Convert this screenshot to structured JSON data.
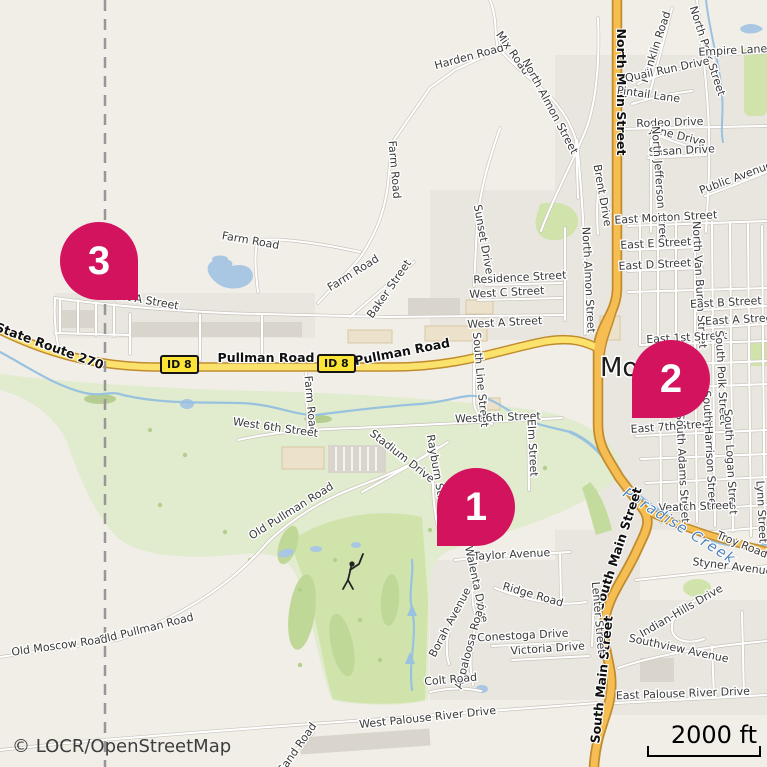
{
  "map": {
    "attribution": "© LOCR/OpenStreetMap",
    "scale_label": "2000 ft",
    "shield_label": "ID 8",
    "city": "Moscow",
    "markers": [
      {
        "number": "1"
      },
      {
        "number": "2"
      },
      {
        "number": "3"
      }
    ],
    "labels": [
      {
        "t": "Harden Road",
        "x": 470,
        "y": 60,
        "r": -15
      },
      {
        "t": "Mix Road",
        "x": 510,
        "y": 55,
        "r": 55
      },
      {
        "t": "North Almon Street",
        "x": 547,
        "y": 108,
        "r": 62
      },
      {
        "t": "Farm Road",
        "x": 391,
        "y": 170,
        "r": 85
      },
      {
        "t": "Farm Road",
        "x": 250,
        "y": 244,
        "r": 10
      },
      {
        "t": "Farm Road",
        "x": 355,
        "y": 276,
        "r": -32
      },
      {
        "t": "Farm Road",
        "x": 307,
        "y": 405,
        "r": 85
      },
      {
        "t": "North Main Street",
        "x": 617,
        "y": 92,
        "r": 90,
        "c": "mainroad"
      },
      {
        "t": "Franklin Road",
        "x": 659,
        "y": 48,
        "r": -72
      },
      {
        "t": "North Polk Street",
        "x": 704,
        "y": 52,
        "r": 72
      },
      {
        "t": "Empire Lane",
        "x": 733,
        "y": 54,
        "r": -3
      },
      {
        "t": "Quail Run Drive",
        "x": 668,
        "y": 73,
        "r": -12
      },
      {
        "t": "Pintail Lane",
        "x": 648,
        "y": 98,
        "r": 8
      },
      {
        "t": "Rodeo Drive",
        "x": 670,
        "y": 126,
        "r": -2
      },
      {
        "t": "June Drive",
        "x": 677,
        "y": 139,
        "r": 14
      },
      {
        "t": "Susan Drive",
        "x": 682,
        "y": 154,
        "r": -3
      },
      {
        "t": "North Jefferson Street",
        "x": 656,
        "y": 186,
        "r": 86
      },
      {
        "t": "Public Avenue",
        "x": 737,
        "y": 181,
        "r": -20
      },
      {
        "t": "Brent Drive",
        "x": 599,
        "y": 196,
        "r": 80
      },
      {
        "t": "East Morton Street",
        "x": 666,
        "y": 221,
        "r": -3
      },
      {
        "t": "East E Street",
        "x": 656,
        "y": 247,
        "r": -3
      },
      {
        "t": "East D Street",
        "x": 655,
        "y": 268,
        "r": -3
      },
      {
        "t": "North Almon Street",
        "x": 585,
        "y": 280,
        "r": 87
      },
      {
        "t": "North Van Buren Street",
        "x": 696,
        "y": 285,
        "r": 87
      },
      {
        "t": "East B Street",
        "x": 726,
        "y": 306,
        "r": -3
      },
      {
        "t": "East A Street",
        "x": 741,
        "y": 323,
        "r": -3
      },
      {
        "t": "East 1st Street",
        "x": 687,
        "y": 341,
        "r": -3
      },
      {
        "t": "Sunset Drive",
        "x": 480,
        "y": 240,
        "r": 80
      },
      {
        "t": "Residence Street",
        "x": 520,
        "y": 281,
        "r": -3
      },
      {
        "t": "West C Street",
        "x": 507,
        "y": 296,
        "r": -3
      },
      {
        "t": "West A Street",
        "x": 505,
        "y": 326,
        "r": -3
      },
      {
        "t": "West A Street",
        "x": 141,
        "y": 303,
        "r": 10
      },
      {
        "t": "Baker Street",
        "x": 392,
        "y": 291,
        "r": -55
      },
      {
        "t": "State Route 270",
        "x": 48,
        "y": 350,
        "r": 20,
        "c": "mainroad"
      },
      {
        "t": "Pullman Road",
        "x": 266,
        "y": 362,
        "r": 0,
        "c": "mainroad"
      },
      {
        "t": "Pullman Road",
        "x": 403,
        "y": 356,
        "r": -11,
        "c": "mainroad"
      },
      {
        "t": "South Line Street",
        "x": 477,
        "y": 380,
        "r": 85
      },
      {
        "t": "Moscow",
        "x": 600,
        "y": 376,
        "r": 0,
        "c": "city"
      },
      {
        "t": "West 6th Street",
        "x": 275,
        "y": 431,
        "r": 8
      },
      {
        "t": "West 6th Street",
        "x": 498,
        "y": 421,
        "r": -2
      },
      {
        "t": "Elm Street",
        "x": 529,
        "y": 448,
        "r": 87
      },
      {
        "t": "Stadium Drive",
        "x": 400,
        "y": 459,
        "r": 38
      },
      {
        "t": "Rayburn Street",
        "x": 434,
        "y": 476,
        "r": 80
      },
      {
        "t": "East 7th Street",
        "x": 672,
        "y": 430,
        "r": -4
      },
      {
        "t": "South Polk Street",
        "x": 718,
        "y": 378,
        "r": 87
      },
      {
        "t": "South Harrison Street",
        "x": 706,
        "y": 450,
        "r": 87
      },
      {
        "t": "South Adams Street",
        "x": 679,
        "y": 468,
        "r": 87
      },
      {
        "t": "South Logan Street",
        "x": 727,
        "y": 462,
        "r": 87
      },
      {
        "t": "Lynn Street",
        "x": 758,
        "y": 512,
        "r": 87
      },
      {
        "t": "Veatch Street",
        "x": 696,
        "y": 510,
        "r": -2
      },
      {
        "t": "Troy Road",
        "x": 741,
        "y": 548,
        "r": 22
      },
      {
        "t": "Paradise Creek",
        "x": 677,
        "y": 530,
        "r": 32,
        "c": "water"
      },
      {
        "t": "Styner Avenue",
        "x": 732,
        "y": 570,
        "r": 7
      },
      {
        "t": "South Main Street",
        "x": 622,
        "y": 550,
        "r": -72,
        "c": "mainroad"
      },
      {
        "t": "South Main Street",
        "x": 606,
        "y": 680,
        "r": -84,
        "c": "mainroad"
      },
      {
        "t": "Taylor Avenue",
        "x": 512,
        "y": 558,
        "r": -3
      },
      {
        "t": "Walenta Drive",
        "x": 473,
        "y": 585,
        "r": 78
      },
      {
        "t": "Ridge Road",
        "x": 532,
        "y": 598,
        "r": 16
      },
      {
        "t": "Lenter Street",
        "x": 595,
        "y": 618,
        "r": 85
      },
      {
        "t": "Indian-Hills Drive",
        "x": 683,
        "y": 614,
        "r": -30
      },
      {
        "t": "Southview Avenue",
        "x": 678,
        "y": 652,
        "r": 12
      },
      {
        "t": "East Palouse River Drive",
        "x": 683,
        "y": 697,
        "r": -2
      },
      {
        "t": "Old Pullman Road",
        "x": 293,
        "y": 514,
        "r": -32
      },
      {
        "t": "Old Pullman Road",
        "x": 147,
        "y": 632,
        "r": -14
      },
      {
        "t": "Old Moscow Road",
        "x": 60,
        "y": 649,
        "r": -8
      },
      {
        "t": "West Palouse River Drive",
        "x": 428,
        "y": 721,
        "r": -6
      },
      {
        "t": "Sand Road",
        "x": 300,
        "y": 750,
        "r": -55
      },
      {
        "t": "Borah Avenue",
        "x": 453,
        "y": 624,
        "r": -62
      },
      {
        "t": "Appaloosa Road",
        "x": 473,
        "y": 647,
        "r": -75
      },
      {
        "t": "Conestoga Drive",
        "x": 523,
        "y": 639,
        "r": -3
      },
      {
        "t": "Victoria Drive",
        "x": 548,
        "y": 652,
        "r": -4
      },
      {
        "t": "Colt Road",
        "x": 451,
        "y": 683,
        "r": -5
      }
    ]
  },
  "colors": {
    "marker": "#d4135e",
    "highway_fill": "#f5bd52",
    "secondary_fill": "#fbe26d",
    "road_casing": "#c08c2e",
    "water_fill": "#a9c6e3",
    "water_line": "#99c1e0",
    "green_park": "#cfe3ab",
    "green_campus": "#e1ebce",
    "background": "#f1eee8"
  }
}
